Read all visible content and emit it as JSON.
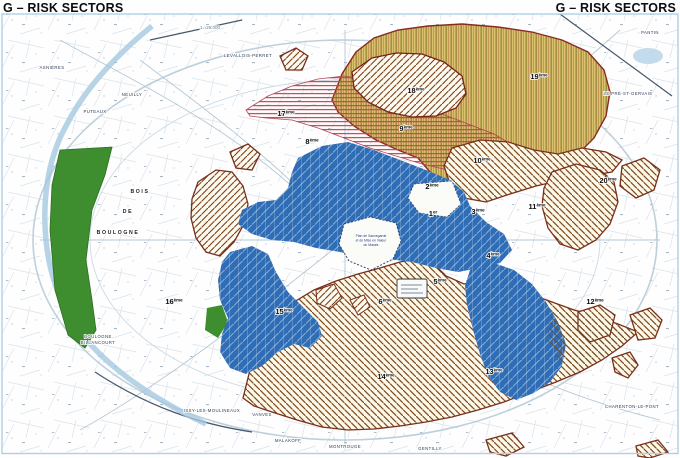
{
  "header": {
    "title_left": "G – RISK SECTORS",
    "title_right": "G – RISK SECTORS"
  },
  "map": {
    "scale_note": "1 : 25.000",
    "arrondissements": [
      {
        "label": "1er",
        "x": 433,
        "y": 216
      },
      {
        "label": "2ème",
        "x": 432,
        "y": 189
      },
      {
        "label": "3ème",
        "x": 478,
        "y": 214
      },
      {
        "label": "4ème",
        "x": 493,
        "y": 258
      },
      {
        "label": "5ème",
        "x": 440,
        "y": 284
      },
      {
        "label": "6ème",
        "x": 385,
        "y": 304
      },
      {
        "label": "8ème",
        "x": 312,
        "y": 144
      },
      {
        "label": "9ème",
        "x": 406,
        "y": 131
      },
      {
        "label": "10ème",
        "x": 482,
        "y": 163
      },
      {
        "label": "11ème",
        "x": 537,
        "y": 209
      },
      {
        "label": "12ème",
        "x": 595,
        "y": 304
      },
      {
        "label": "13ème",
        "x": 494,
        "y": 374
      },
      {
        "label": "14ème",
        "x": 386,
        "y": 379
      },
      {
        "label": "15ème",
        "x": 284,
        "y": 314
      },
      {
        "label": "16ème",
        "x": 174,
        "y": 304
      },
      {
        "label": "17ème",
        "x": 286,
        "y": 116
      },
      {
        "label": "18ème",
        "x": 416,
        "y": 93
      },
      {
        "label": "19ème",
        "x": 539,
        "y": 79
      },
      {
        "label": "20ème",
        "x": 608,
        "y": 183
      }
    ],
    "area_labels": [
      {
        "text": "BOIS",
        "x": 140,
        "y": 193
      },
      {
        "text": "DE",
        "x": 128,
        "y": 213
      },
      {
        "text": "BOULOGNE",
        "x": 118,
        "y": 234
      }
    ],
    "peripheral_labels": [
      {
        "text": "LEVALLOIS-PERRET",
        "x": 248,
        "y": 57
      },
      {
        "text": "ASNIÈRES",
        "x": 52,
        "y": 69
      },
      {
        "text": "PUTEAUX",
        "x": 95,
        "y": 113
      },
      {
        "text": "NEUILLY",
        "x": 132,
        "y": 96
      },
      {
        "text": "PANTIN",
        "x": 650,
        "y": 34
      },
      {
        "text": "LE PRÉ-ST-GERVAIS",
        "x": 628,
        "y": 95
      },
      {
        "text": "BOULOGNE",
        "x": 98,
        "y": 338
      },
      {
        "text": "BILLANCOURT",
        "x": 98,
        "y": 344
      },
      {
        "text": "ISSY-LES-MOULINEAUX",
        "x": 212,
        "y": 412
      },
      {
        "text": "VANVES",
        "x": 262,
        "y": 416
      },
      {
        "text": "MALAKOFF",
        "x": 288,
        "y": 442
      },
      {
        "text": "MONTROUGE",
        "x": 345,
        "y": 448
      },
      {
        "text": "GENTILLY",
        "x": 430,
        "y": 450
      },
      {
        "text": "CHARENTON-LE-PONT",
        "x": 632,
        "y": 408
      }
    ],
    "inset_note_lines": [
      "Plan de Sauvegarde",
      "et de Mise en Valeur",
      "du Marais"
    ],
    "zone_colors": {
      "flood_blue": "#2f6db6",
      "hatch_brown": "#7b4a20",
      "hatch_border": "#7a2e1a",
      "tan_fill": "#d9c170",
      "tan_stripe": "#9b8c3a",
      "red_stripe": "#c04858",
      "green": "#3e8e2f",
      "frame_blue": "#aed0e6"
    }
  }
}
